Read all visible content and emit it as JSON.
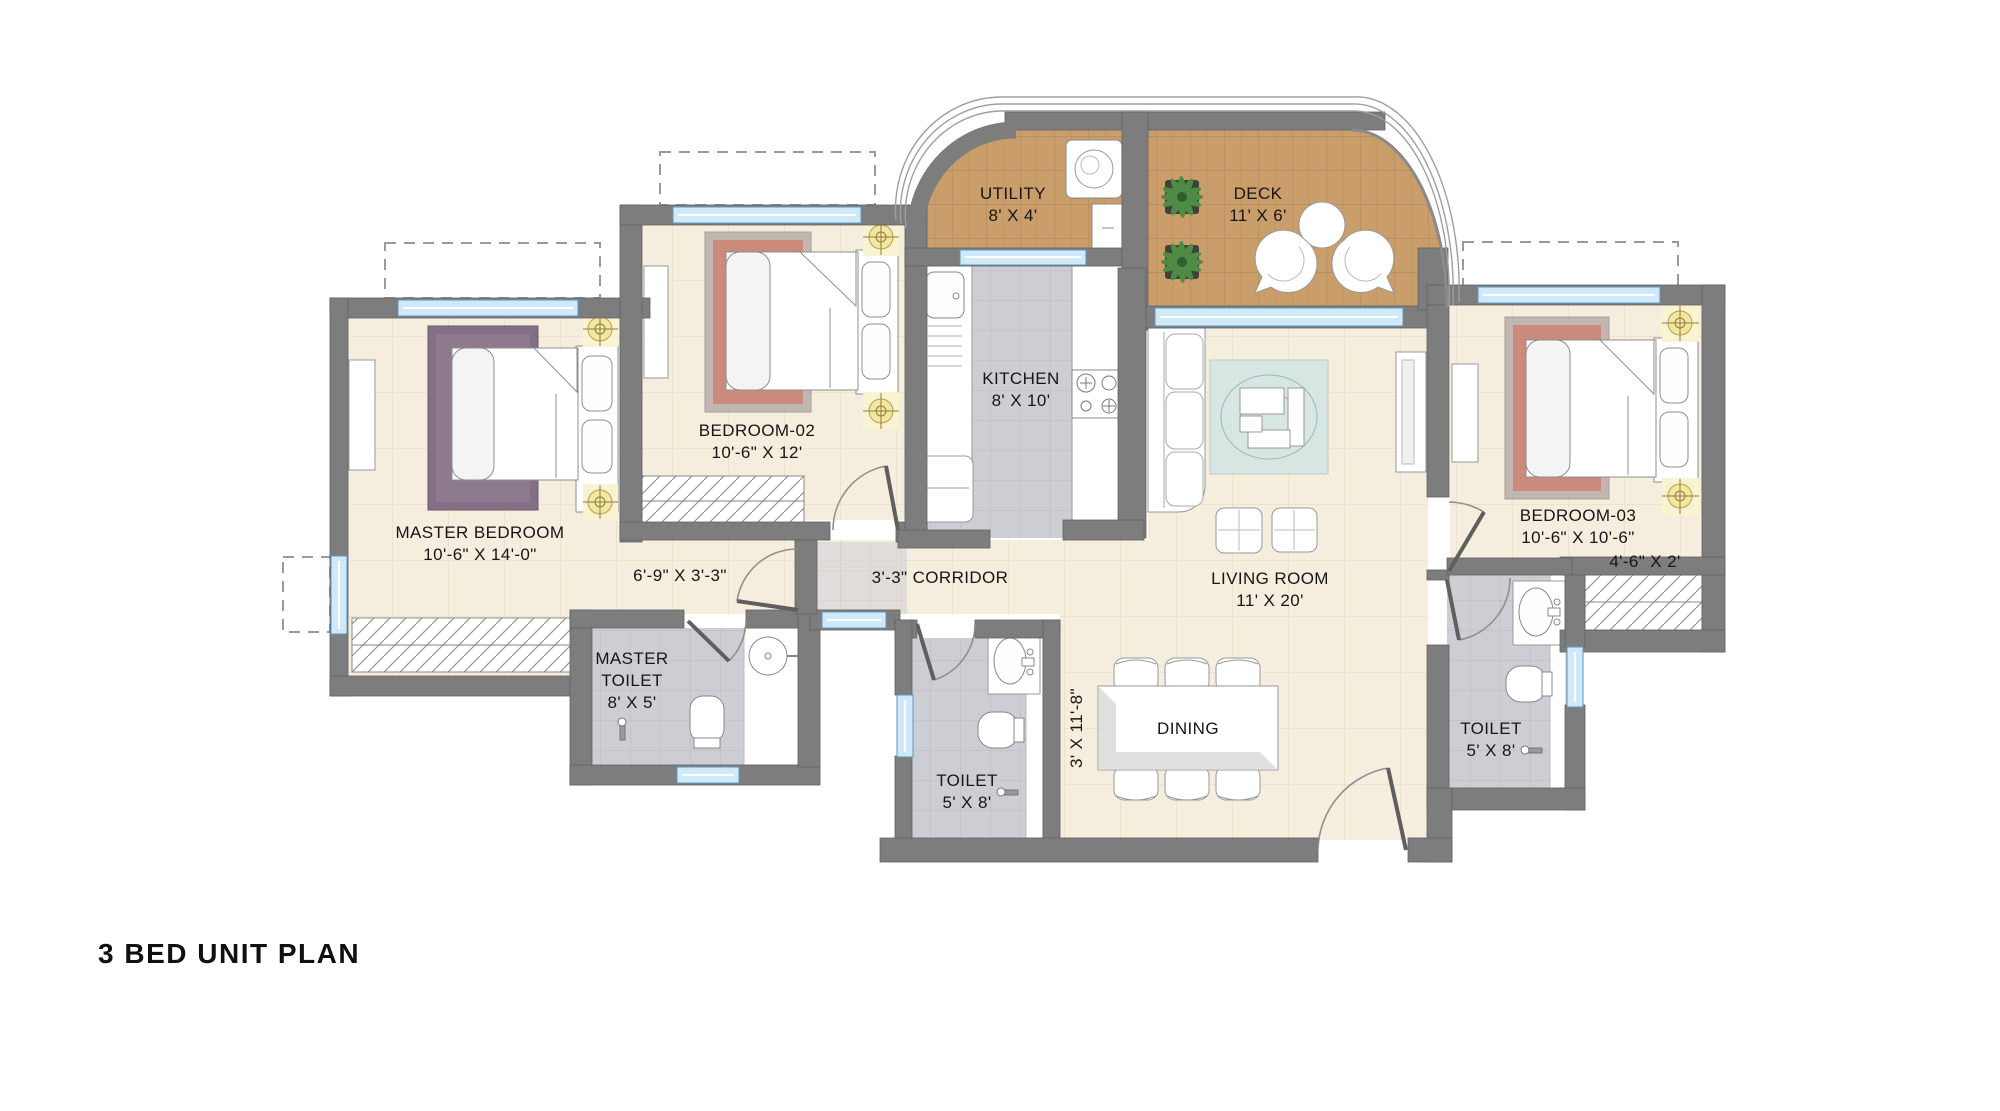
{
  "title": "3 BED UNIT PLAN",
  "rooms": {
    "utility": {
      "name": "UTILITY",
      "dims": "8' X 4'"
    },
    "deck": {
      "name": "DECK",
      "dims": "11' X 6'"
    },
    "kitchen": {
      "name": "KITCHEN",
      "dims": "8' X 10'"
    },
    "bedroom02": {
      "name": "BEDROOM-02",
      "dims": "10'-6\" X 12'"
    },
    "master_bedroom": {
      "name": "MASTER BEDROOM",
      "dims": "10'-6\" X 14'-0\""
    },
    "bedroom03": {
      "name": "BEDROOM-03",
      "dims": "10'-6\" X 10'-6\"",
      "wardrobe_dims": "4'-6\" X 2'"
    },
    "living_room": {
      "name": "LIVING ROOM",
      "dims": "11' X 20'"
    },
    "master_toilet": {
      "name": "MASTER TOILET",
      "dims": "8' X 5'"
    },
    "toilet_mid": {
      "name": "TOILET",
      "dims": "5' X 8'"
    },
    "toilet_right": {
      "name": "TOILET",
      "dims": "5' X 8'"
    },
    "dining": {
      "name": "DINING",
      "dims": "3' X 11'-8\""
    },
    "corridor": {
      "left_dims": "6'-9\" X 3'-3\"",
      "label": "3'-3\" CORRIDOR"
    }
  },
  "colors": {
    "wall": "#7d7d7d",
    "window": "#cfe9f9",
    "floor_cream": "#f5edde",
    "floor_gray": "#cdced4",
    "floor_wood": "#c99e6b",
    "lamp_accent": "#f3e6a0",
    "rug_master": "#846f85",
    "rug_red": "#cc7f6f",
    "rug_living": "#d7e6e0"
  }
}
